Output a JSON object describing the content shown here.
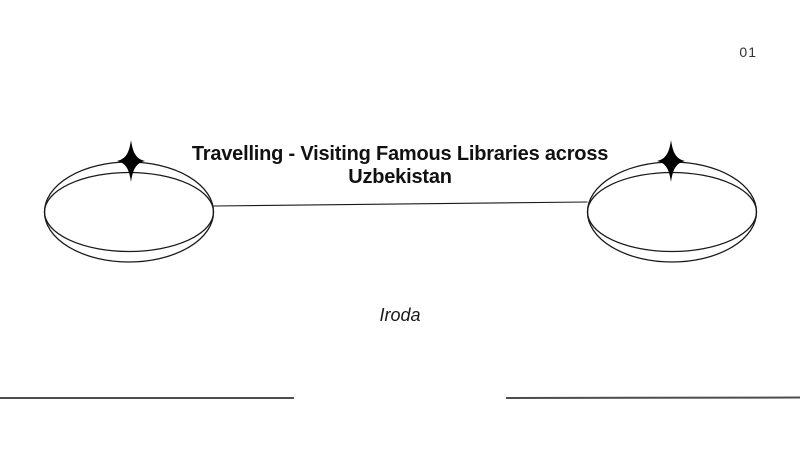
{
  "slide": {
    "page_number": "01",
    "title_line1": "Travelling - Visiting Famous Libraries across",
    "title_line2": "Uzbekistan",
    "subtitle": "Iroda"
  },
  "colors": {
    "background": "#ffffff",
    "title_text": "#111111",
    "subtitle_text": "#1a1a1a",
    "page_number_text": "#333333",
    "shape_stroke": "#1a1a1a",
    "sparkle_fill": "#000000",
    "footer_rule": "#4d4d4d"
  },
  "icons": {
    "left_sparkle": "four-point-star",
    "right_sparkle": "four-point-star"
  }
}
